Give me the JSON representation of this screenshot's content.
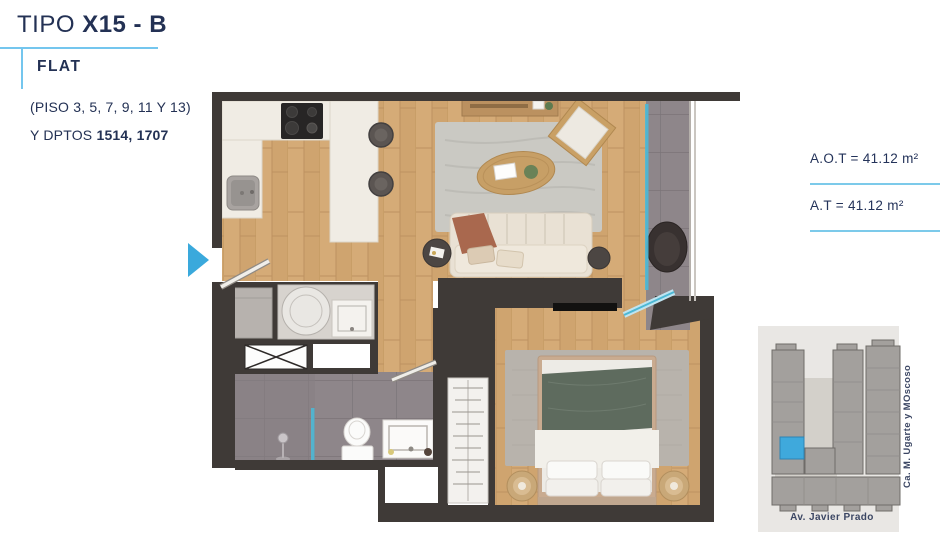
{
  "header": {
    "title_prefix": "TIPO",
    "title_bold": "X15 - B",
    "type_label": "FLAT",
    "floors": "(PISO 3, 5, 7, 9, 11 Y 13)",
    "units_prefix": "Y DPTOS ",
    "units_bold": "1514, 1707"
  },
  "areas": {
    "rows": [
      {
        "text": "A.O.T = 41.12 m²"
      },
      {
        "text": "A.T = 41.12 m²"
      }
    ]
  },
  "map": {
    "street_right": "Ca. M. Ugarte y MOscoso",
    "street_bottom": "Av. Javier Prado"
  },
  "colors": {
    "navy_text": "#233154",
    "accent_blue": "#3aa9dc",
    "line_blue": "#7ccaea",
    "wall_dark": "#3f3a37",
    "wood_floor": "#cfa46f",
    "tile_gray": "#8e868a",
    "glass_cyan": "#4db8d5",
    "map_building_gray": "#a3a09d",
    "map_unit_blue": "#3fa9dc"
  }
}
